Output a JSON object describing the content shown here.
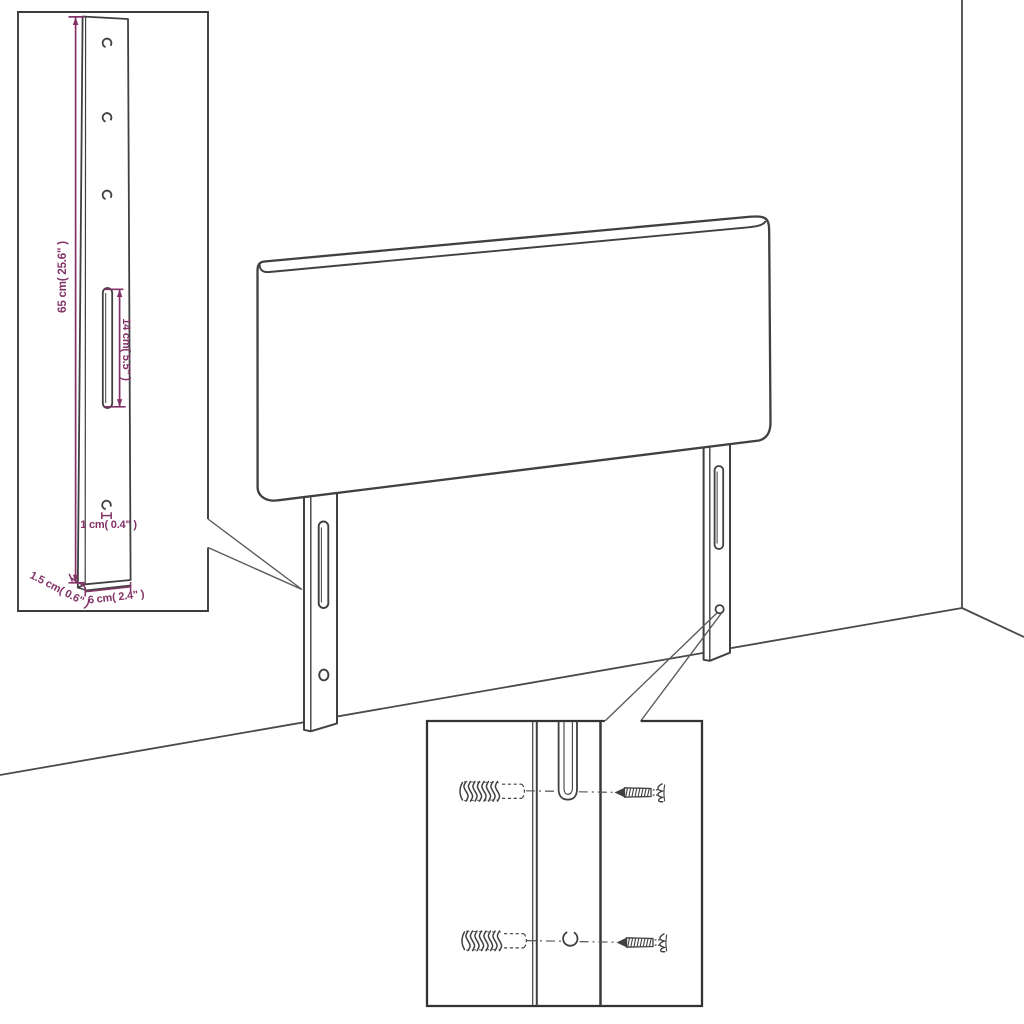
{
  "canvas": {
    "background": "#ffffff"
  },
  "colors": {
    "outline": "#404040",
    "outline_strong": "#333333",
    "callout_line": "#5b5b5b",
    "dimension": "#833367"
  },
  "dimension_labels": {
    "height": "65 cm( 25.6\" )",
    "slot_length": "14 cm( 5.5\" )",
    "hole_diameter": "1 cm( 0.4\" )",
    "side_depth": "1.5 cm( 0.6\" )",
    "leg_width": "6 cm( 2.4\" )"
  },
  "icons": [
    "headboard-panel",
    "mounting-leg-left-icon",
    "mounting-leg-right-icon",
    "leg-slot-icon",
    "leg-hole-icon",
    "wall-corner-line",
    "floor-line",
    "leg-detail-inset",
    "hardware-detail-inset",
    "wall-plug-icon",
    "screw-icon"
  ]
}
